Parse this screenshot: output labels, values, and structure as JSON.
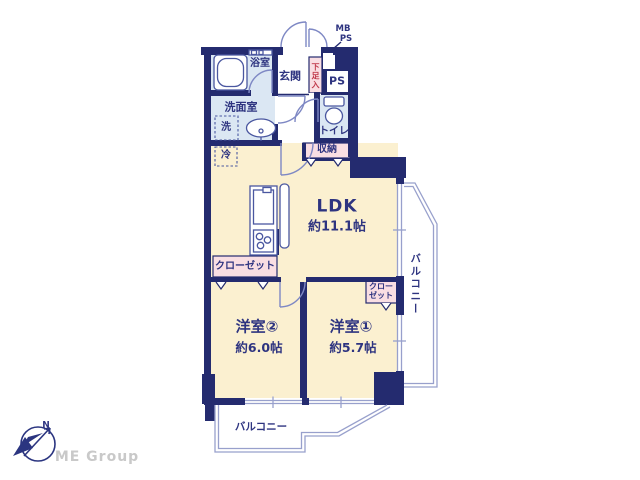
{
  "colors": {
    "wall": "#242b6f",
    "text": "#2e3480",
    "cream": "#fbf0d0",
    "wet": "#dbe7f3",
    "pink": "#f9dee3",
    "line": "#98a0cc",
    "door": "#7e88c4",
    "fixture": "#4a57a0",
    "red": "#c0394b",
    "logo_navy": "#2b3580",
    "logo_gray": "#c9c9c9"
  },
  "labels": {
    "mb": "MB",
    "ps_shaft": "PS",
    "ps_room": "PS",
    "entrance": "玄関",
    "shoe_cabinet": "下足入",
    "bathroom": "浴室",
    "washroom": "洗面室",
    "washer": "洗",
    "toilet": "トイレ",
    "storage": "収納",
    "fridge": "冷",
    "ldk": "LDK",
    "ldk_size": "約11.1帖",
    "closet_room2": "クローゼット",
    "closet_room1_line1": "クロー",
    "closet_room1_line2": "ゼット",
    "room2": "洋室②",
    "room2_size": "約6.0帖",
    "room1": "洋室①",
    "room1_size": "約5.7帖",
    "balcony_south": "バルコニー",
    "balcony_east": "バルコニー",
    "north_mark": "N"
  },
  "footer": {
    "logo_text": "ME Group"
  }
}
